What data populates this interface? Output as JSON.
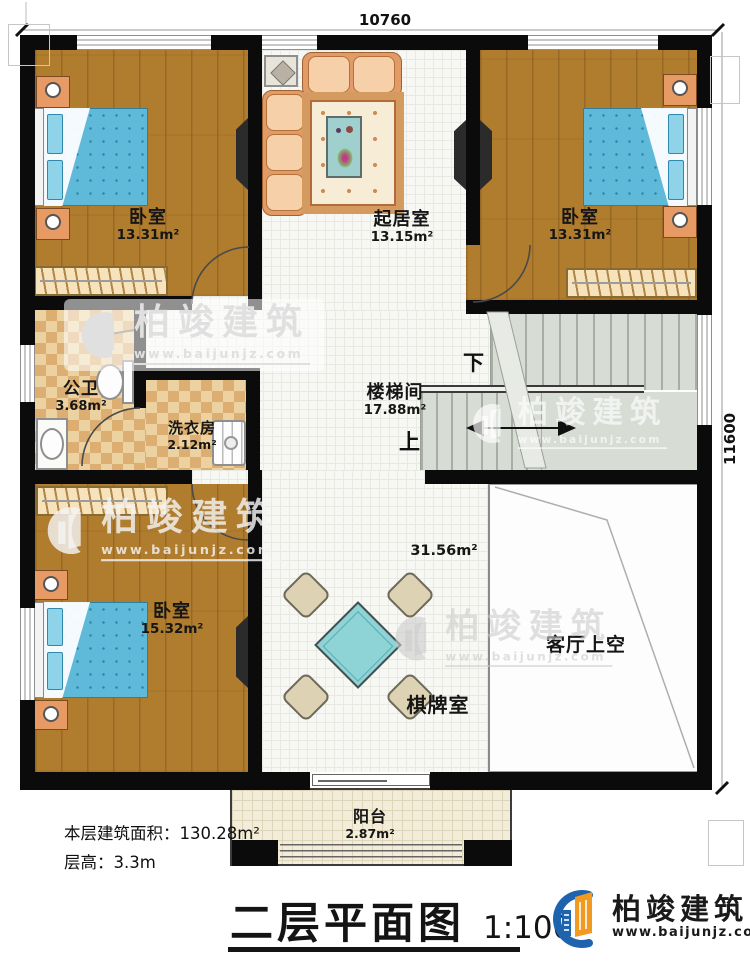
{
  "dimensions": {
    "top": "10760",
    "right": "11600"
  },
  "rooms": {
    "bedroom_top_left": {
      "name": "卧室",
      "area": "13.31m²"
    },
    "living_room": {
      "name": "起居室",
      "area": "13.15m²"
    },
    "bedroom_top_right": {
      "name": "卧室",
      "area": "13.31m²"
    },
    "bathroom": {
      "name": "公卫",
      "area": "3.68m²"
    },
    "laundry_room": {
      "name": "洗衣房",
      "area": "2.12m²"
    },
    "stairwell": {
      "name": "楼梯间",
      "area": "17.88m²",
      "down_label": "下",
      "up_label": "上"
    },
    "bedroom_bottom_left": {
      "name": "卧室",
      "area": "15.32m²"
    },
    "game_room": {
      "name": "棋牌室",
      "area": "31.56m²"
    },
    "living_void": {
      "name": "客厅上空"
    },
    "balcony": {
      "name": "阳台",
      "area": "2.87m²"
    }
  },
  "info": {
    "floor_area_label": "本层建筑面积：",
    "floor_area_value": "130.28m²",
    "floor_height_label": "层高：",
    "floor_height_value": "3.3m"
  },
  "title_block": {
    "title": "二层平面图",
    "scale": "1:100"
  },
  "brand": {
    "name": "柏竣建筑",
    "website": "www.baijunjz.com"
  },
  "watermark": {
    "name": "柏竣建筑",
    "website": "www.baijunjz.com"
  },
  "colors": {
    "wall": "#0b0b0b",
    "wood_floor": "#b07c2e",
    "tile_floor": "#f7f7f4",
    "checker_tile": "#dcae72",
    "stair": "#d7dcd4",
    "bed": "#5fb9d8",
    "sofa": "#e29b66",
    "game_table": "#8ed4d6",
    "balcony_tile": "#f2ecd8",
    "brand_blue": "#1e63ad",
    "brand_orange": "#f19a1f"
  }
}
